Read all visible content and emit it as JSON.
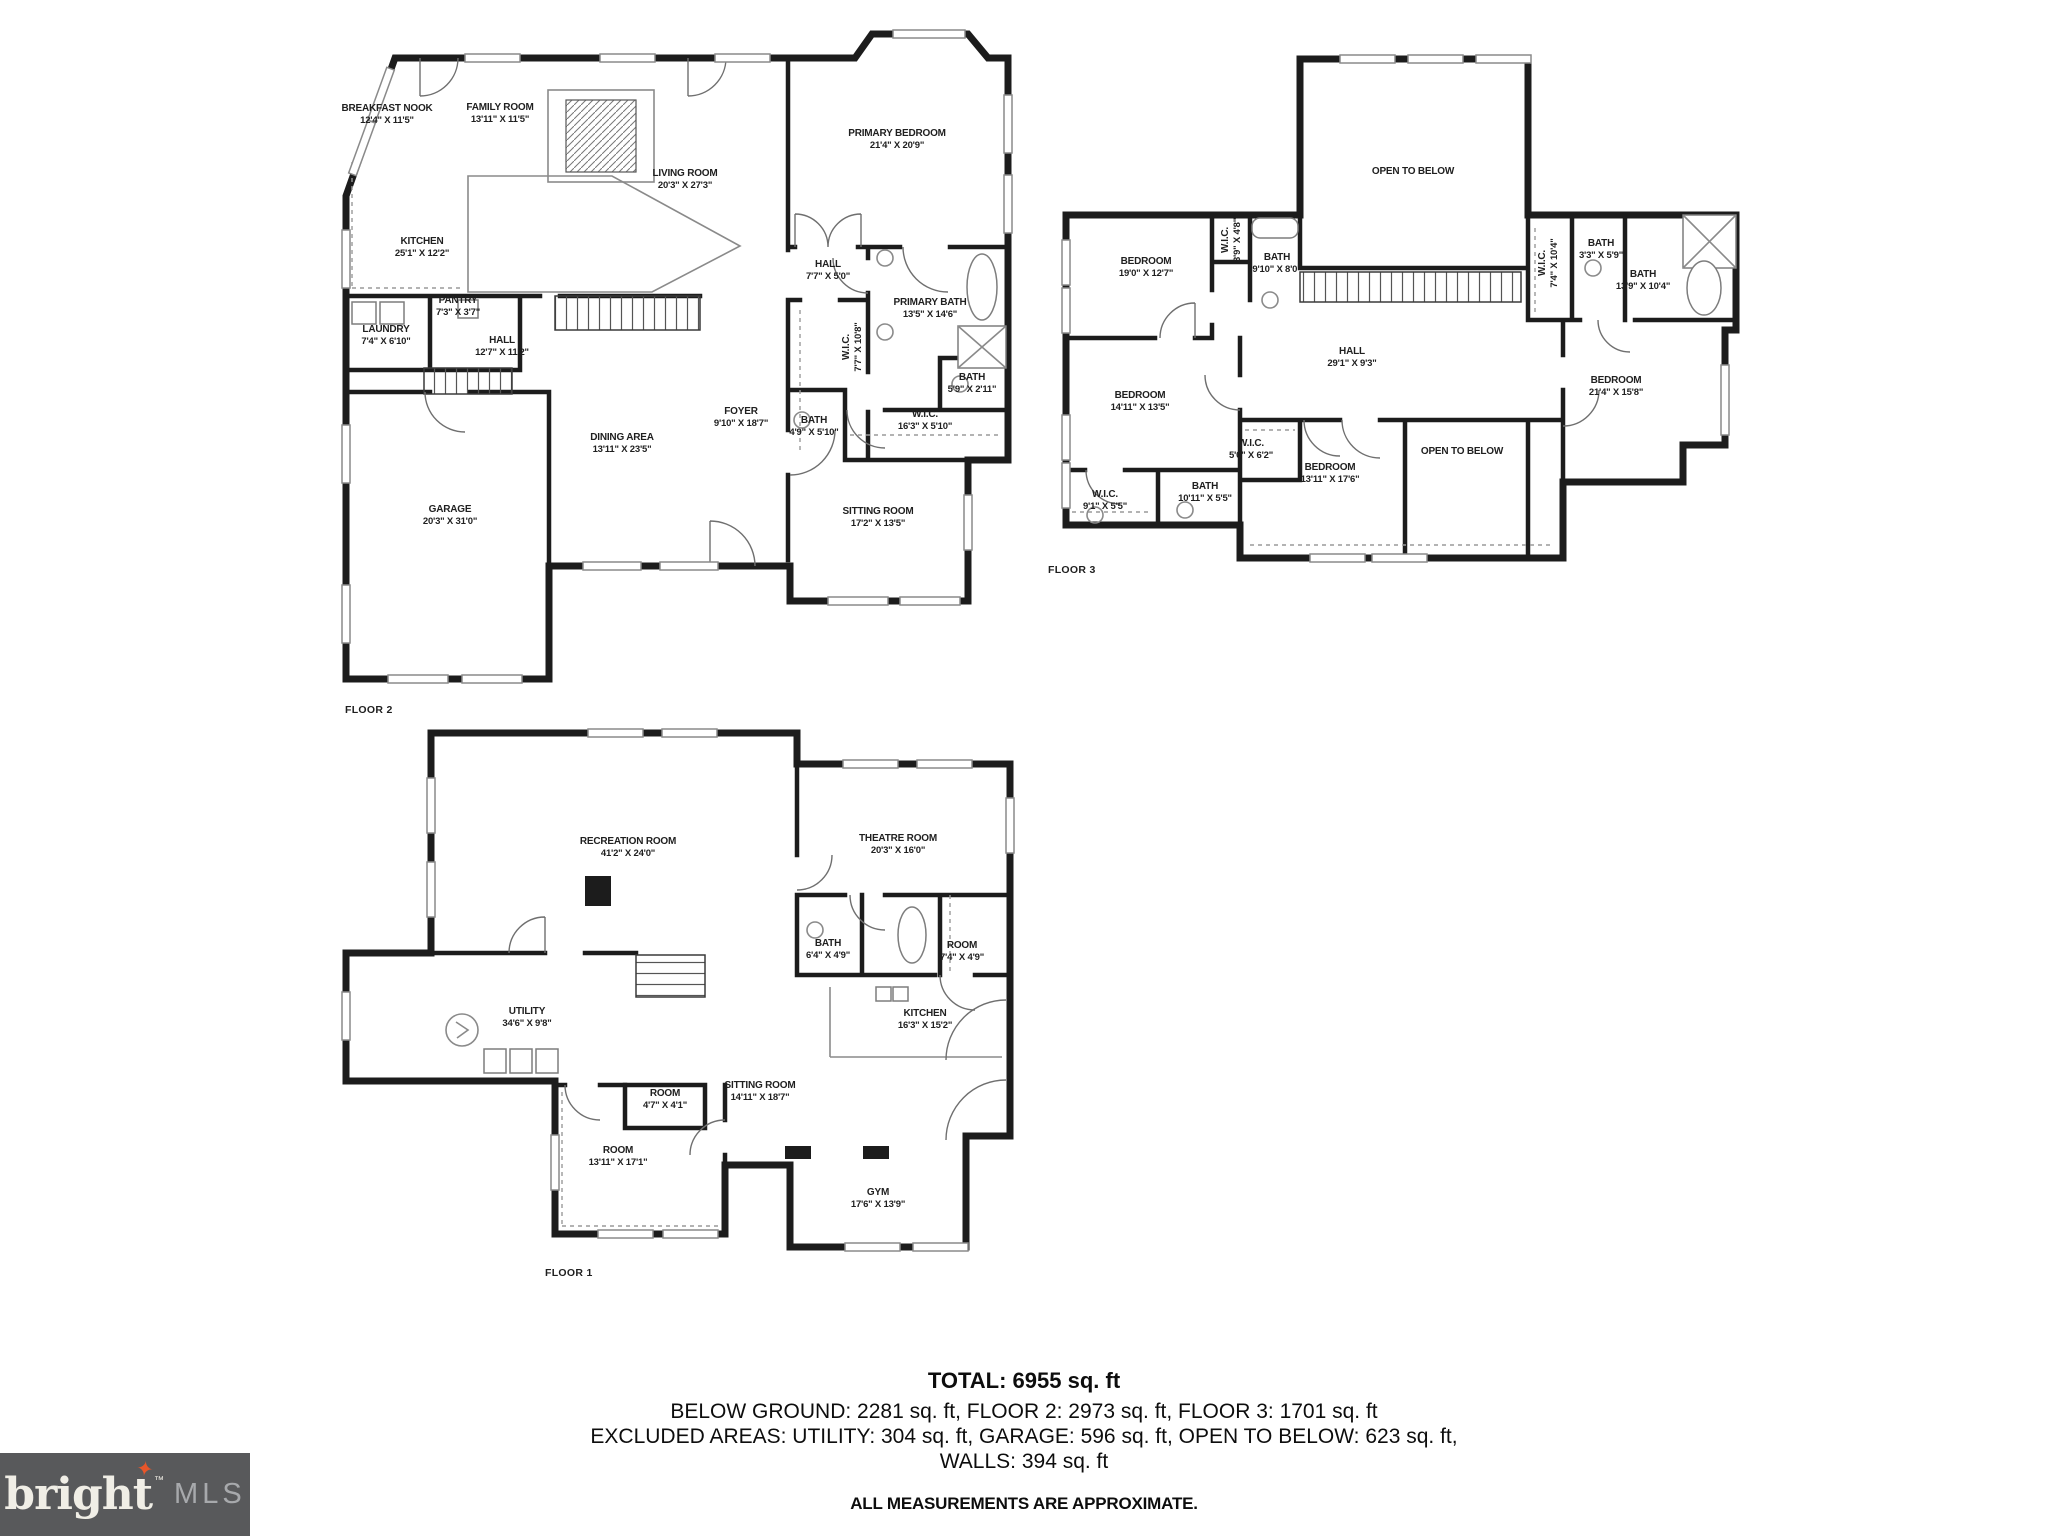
{
  "colors": {
    "wall": "#1c1c1c",
    "label": "#1f1f1f",
    "background": "#ffffff",
    "logo_bg": "#58595b",
    "logo_text": "#f0eee6",
    "logo_mls": "#a7a9ac",
    "star": "#e8562a"
  },
  "floors": [
    {
      "id": "floor-2",
      "label": "FLOOR 2",
      "label_x": 345,
      "label_y": 710,
      "rooms": [
        {
          "name": "BREAKFAST NOOK",
          "dims": "12'4\" X 11'5\"",
          "x": 387,
          "y": 115
        },
        {
          "name": "FAMILY ROOM",
          "dims": "13'11\" X 11'5\"",
          "x": 500,
          "y": 114
        },
        {
          "name": "LIVING ROOM",
          "dims": "20'3\" X 27'3\"",
          "x": 685,
          "y": 180
        },
        {
          "name": "PRIMARY BEDROOM",
          "dims": "21'4\" X 20'9\"",
          "x": 897,
          "y": 140
        },
        {
          "name": "KITCHEN",
          "dims": "25'1\" X 12'2\"",
          "x": 422,
          "y": 248
        },
        {
          "name": "HALL",
          "dims": "7'7\" X 5'0\"",
          "x": 828,
          "y": 271
        },
        {
          "name": "PRIMARY BATH",
          "dims": "13'5\" X 14'6\"",
          "x": 930,
          "y": 309
        },
        {
          "name": "PANTRY",
          "dims": "7'3\" X 3'7\"",
          "x": 458,
          "y": 307
        },
        {
          "name": "LAUNDRY",
          "dims": "7'4\" X 6'10\"",
          "x": 386,
          "y": 336
        },
        {
          "name": "HALL",
          "dims": "12'7\" X 11'2\"",
          "x": 502,
          "y": 347
        },
        {
          "name": "W.I.C.",
          "dims": "7'7\" X 10'8\"",
          "x": 853,
          "y": 347,
          "rot": -90
        },
        {
          "name": "BATH",
          "dims": "5'9\" X 2'11\"",
          "x": 972,
          "y": 384
        },
        {
          "name": "BATH",
          "dims": "4'9\" X 5'10\"",
          "x": 814,
          "y": 427
        },
        {
          "name": "W.I.C.",
          "dims": "16'3\" X 5'10\"",
          "x": 925,
          "y": 421
        },
        {
          "name": "DINING AREA",
          "dims": "13'11\" X 23'5\"",
          "x": 622,
          "y": 444
        },
        {
          "name": "FOYER",
          "dims": "9'10\" X 18'7\"",
          "x": 741,
          "y": 418
        },
        {
          "name": "GARAGE",
          "dims": "20'3\" X 31'0\"",
          "x": 450,
          "y": 516
        },
        {
          "name": "SITTING ROOM",
          "dims": "17'2\" X 13'5\"",
          "x": 878,
          "y": 518
        }
      ]
    },
    {
      "id": "floor-3",
      "label": "FLOOR 3",
      "label_x": 1048,
      "label_y": 570,
      "rooms": [
        {
          "name": "OPEN TO BELOW",
          "dims": "",
          "x": 1413,
          "y": 172
        },
        {
          "name": "BEDROOM",
          "dims": "19'0\" X 12'7\"",
          "x": 1146,
          "y": 268
        },
        {
          "name": "W.I.C.",
          "dims": "3'9\" X 4'8\"",
          "x": 1232,
          "y": 240,
          "rot": -90
        },
        {
          "name": "BATH",
          "dims": "9'10\" X 8'0\"",
          "x": 1277,
          "y": 264
        },
        {
          "name": "W.I.C.",
          "dims": "7'4\" X 10'4\"",
          "x": 1549,
          "y": 263,
          "rot": -90
        },
        {
          "name": "BATH",
          "dims": "3'3\" X 5'9\"",
          "x": 1601,
          "y": 250
        },
        {
          "name": "BATH",
          "dims": "13'9\" X 10'4\"",
          "x": 1643,
          "y": 281
        },
        {
          "name": "HALL",
          "dims": "29'1\" X 9'3\"",
          "x": 1352,
          "y": 358
        },
        {
          "name": "BEDROOM",
          "dims": "14'11\" X 13'5\"",
          "x": 1140,
          "y": 402
        },
        {
          "name": "BEDROOM",
          "dims": "21'4\" X 15'8\"",
          "x": 1616,
          "y": 387
        },
        {
          "name": "W.I.C.",
          "dims": "5'0\" X 6'2\"",
          "x": 1251,
          "y": 450
        },
        {
          "name": "BEDROOM",
          "dims": "13'11\" X 17'6\"",
          "x": 1330,
          "y": 474
        },
        {
          "name": "OPEN TO BELOW",
          "dims": "",
          "x": 1462,
          "y": 452
        },
        {
          "name": "W.I.C.",
          "dims": "9'1\" X 5'5\"",
          "x": 1105,
          "y": 501
        },
        {
          "name": "BATH",
          "dims": "10'11\" X 5'5\"",
          "x": 1205,
          "y": 493
        }
      ]
    },
    {
      "id": "floor-1",
      "label": "FLOOR 1",
      "label_x": 545,
      "label_y": 1273,
      "rooms": [
        {
          "name": "RECREATION ROOM",
          "dims": "41'2\" X 24'0\"",
          "x": 628,
          "y": 848
        },
        {
          "name": "THEATRE ROOM",
          "dims": "20'3\" X 16'0\"",
          "x": 898,
          "y": 845
        },
        {
          "name": "BATH",
          "dims": "6'4\" X 4'9\"",
          "x": 828,
          "y": 950
        },
        {
          "name": "ROOM",
          "dims": "7'4\" X 4'9\"",
          "x": 962,
          "y": 952
        },
        {
          "name": "UTILITY",
          "dims": "34'6\" X 9'8\"",
          "x": 527,
          "y": 1018
        },
        {
          "name": "KITCHEN",
          "dims": "16'3\" X 15'2\"",
          "x": 925,
          "y": 1020
        },
        {
          "name": "SITTING ROOM",
          "dims": "14'11\" X 18'7\"",
          "x": 760,
          "y": 1092
        },
        {
          "name": "ROOM",
          "dims": "4'7\" X 4'1\"",
          "x": 665,
          "y": 1100
        },
        {
          "name": "ROOM",
          "dims": "13'11\" X 17'1\"",
          "x": 618,
          "y": 1157
        },
        {
          "name": "GYM",
          "dims": "17'6\" X 13'9\"",
          "x": 878,
          "y": 1199
        }
      ]
    }
  ],
  "summary": {
    "total": "TOTAL: 6955 sq. ft",
    "line2": "BELOW GROUND: 2281 sq. ft, FLOOR 2: 2973 sq. ft, FLOOR 3: 1701 sq. ft",
    "line3": "EXCLUDED AREAS: UTILITY: 304 sq. ft, GARAGE: 596 sq. ft, OPEN TO BELOW: 623 sq. ft,",
    "line4": "WALLS: 394 sq. ft",
    "disclaimer": "ALL MEASUREMENTS ARE APPROXIMATE."
  },
  "logo": {
    "brand": "bright",
    "tm": "™",
    "suffix": "MLS",
    "star_icon": "✦"
  }
}
